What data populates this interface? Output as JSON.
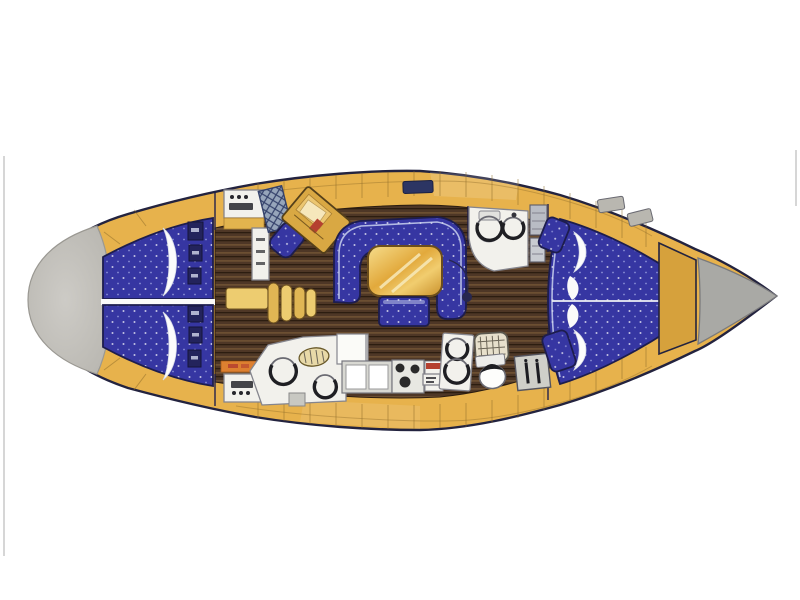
{
  "figure": {
    "type": "floor-plan",
    "subject": "sailing-yacht-interior-top-view",
    "orientation": "bow-right-stern-left"
  },
  "colors": {
    "background": "#ffffff",
    "hull_outline": "#23233f",
    "deck_yellow": "#e7b24c",
    "deck_yellow_dark": "#d6a13c",
    "deck_seam": "#8c6a28",
    "stern_gray": "#b9b7b1",
    "stern_gray_light": "#cdcbc6",
    "bow_gray": "#a9a9a5",
    "upholstery_blue": "#3636a2",
    "upholstery_navy": "#1d1d4e",
    "upholstery_piping": "#c9d1ee",
    "floor_brown": "#4e3726",
    "floor_brown_light": "#7d5c38",
    "floor_brown_dark": "#2c1d10",
    "table_gold": "#e2a93c",
    "table_gold_light": "#f6dd8c",
    "table_gold_dark": "#c9902b",
    "step_yellow": "#edcc70",
    "step_yellow_alt": "#e0b654",
    "counter_white": "#f2f1ec",
    "fixture_outline": "#85858d",
    "fixture_dark": "#26262c",
    "hatch_panel_blue": "#96a5ba",
    "hatch_line": "#35426b",
    "accent_red": "#b5402f",
    "label_orange": "#dd8030"
  }
}
